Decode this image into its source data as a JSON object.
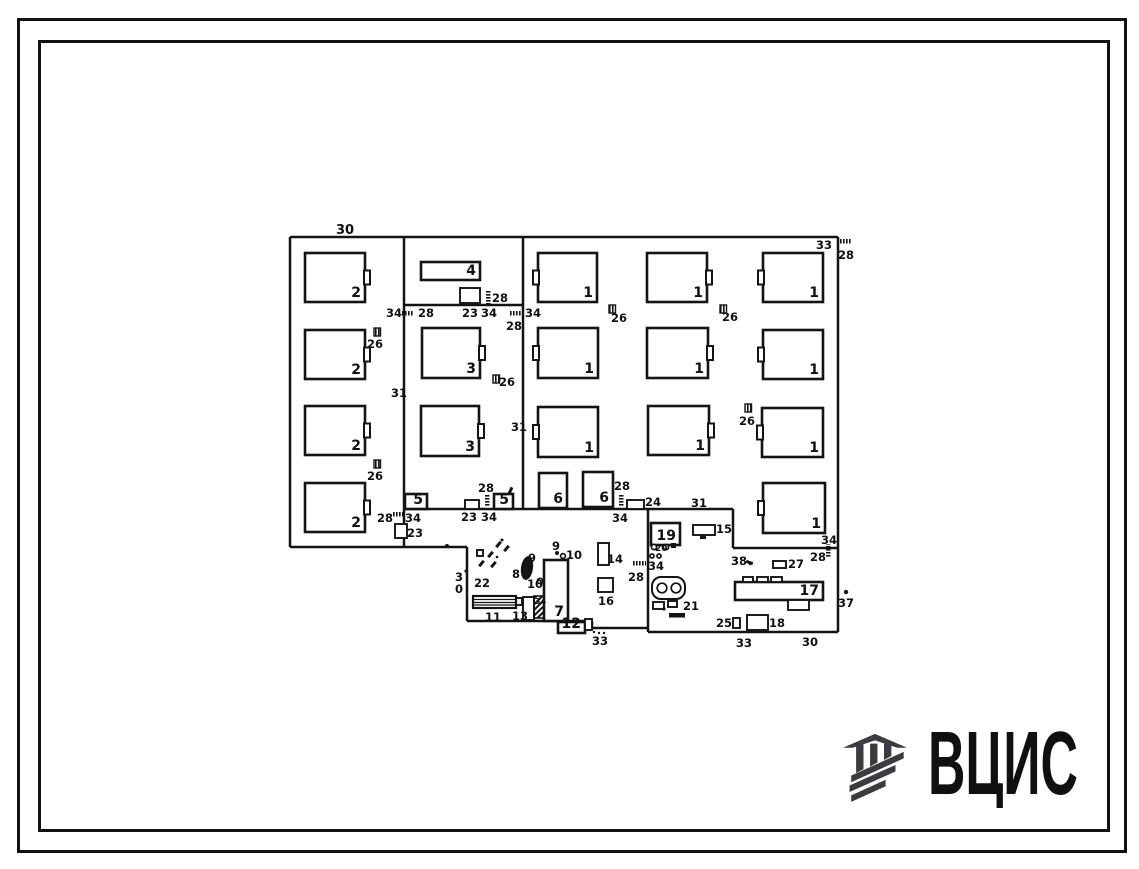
{
  "logo": {
    "text": "ВЦИС",
    "color": "#3b3b40"
  },
  "plan": {
    "stroke_color": "#141414",
    "walls": [
      [
        290,
        237,
        838,
        237
      ],
      [
        290,
        237,
        290,
        547
      ],
      [
        290,
        547,
        467,
        547
      ],
      [
        467,
        547,
        467,
        621
      ],
      [
        467,
        621,
        592,
        621
      ],
      [
        592,
        621,
        592,
        628
      ],
      [
        592,
        628,
        648,
        628
      ],
      [
        648,
        509,
        648,
        632
      ],
      [
        648,
        632,
        838,
        632
      ],
      [
        838,
        237,
        838,
        632
      ],
      [
        404,
        237,
        404,
        547
      ],
      [
        523,
        237,
        523,
        509
      ],
      [
        404,
        305,
        523,
        305
      ],
      [
        404,
        509,
        733,
        509
      ],
      [
        733,
        509,
        733,
        548
      ],
      [
        733,
        548,
        838,
        548
      ]
    ],
    "machines": [
      {
        "x": 305,
        "y": 253,
        "w": 60,
        "h": 49,
        "l": "2",
        "n": "r"
      },
      {
        "x": 305,
        "y": 330,
        "w": 60,
        "h": 49,
        "l": "2",
        "n": "r"
      },
      {
        "x": 305,
        "y": 406,
        "w": 60,
        "h": 49,
        "l": "2",
        "n": "r"
      },
      {
        "x": 305,
        "y": 483,
        "w": 60,
        "h": 49,
        "l": "2",
        "n": "r"
      },
      {
        "x": 421,
        "y": 262,
        "w": 59,
        "h": 18,
        "l": "4"
      },
      {
        "x": 422,
        "y": 328,
        "w": 58,
        "h": 50,
        "l": "3",
        "n": "r"
      },
      {
        "x": 421,
        "y": 406,
        "w": 58,
        "h": 50,
        "l": "3",
        "n": "r"
      },
      {
        "x": 538,
        "y": 253,
        "w": 59,
        "h": 49,
        "l": "1",
        "n": "l"
      },
      {
        "x": 647,
        "y": 253,
        "w": 60,
        "h": 49,
        "l": "1",
        "n": "r"
      },
      {
        "x": 763,
        "y": 253,
        "w": 60,
        "h": 49,
        "l": "1",
        "n": "l"
      },
      {
        "x": 538,
        "y": 328,
        "w": 60,
        "h": 50,
        "l": "1",
        "n": "l"
      },
      {
        "x": 647,
        "y": 328,
        "w": 61,
        "h": 50,
        "l": "1",
        "n": "r"
      },
      {
        "x": 763,
        "y": 330,
        "w": 60,
        "h": 49,
        "l": "1",
        "n": "l"
      },
      {
        "x": 538,
        "y": 407,
        "w": 60,
        "h": 50,
        "l": "1",
        "n": "l"
      },
      {
        "x": 648,
        "y": 406,
        "w": 61,
        "h": 49,
        "l": "1",
        "n": "r"
      },
      {
        "x": 762,
        "y": 408,
        "w": 61,
        "h": 49,
        "l": "1",
        "n": "l"
      },
      {
        "x": 763,
        "y": 483,
        "w": 62,
        "h": 50,
        "l": "1",
        "n": "l"
      },
      {
        "x": 405,
        "y": 494,
        "w": 22,
        "h": 15,
        "l": "5"
      },
      {
        "x": 494,
        "y": 494,
        "w": 19,
        "h": 15,
        "l": "5"
      },
      {
        "x": 539,
        "y": 473,
        "w": 28,
        "h": 35,
        "l": "6"
      },
      {
        "x": 583,
        "y": 472,
        "w": 30,
        "h": 35,
        "l": "6"
      },
      {
        "x": 651,
        "y": 523,
        "w": 29,
        "h": 22,
        "l": "19"
      },
      {
        "x": 544,
        "y": 560,
        "w": 24,
        "h": 61,
        "l": "7"
      },
      {
        "x": 558,
        "y": 622,
        "w": 27,
        "h": 11,
        "l": "12"
      },
      {
        "x": 735,
        "y": 582,
        "w": 88,
        "h": 18,
        "l": "17"
      }
    ],
    "smallrects": [
      [
        465,
        500,
        14,
        9
      ],
      [
        395,
        524,
        12,
        14
      ],
      [
        460,
        288,
        20,
        15
      ],
      [
        627,
        500,
        17,
        9
      ],
      [
        773,
        561,
        13,
        7
      ],
      [
        693,
        525,
        22,
        10
      ],
      [
        598,
        543,
        11,
        22
      ],
      [
        598,
        578,
        15,
        14
      ],
      [
        523,
        597,
        11,
        23
      ],
      [
        747,
        615,
        21,
        15
      ],
      [
        733,
        618,
        7,
        10
      ],
      [
        585,
        619,
        7,
        11
      ],
      [
        516,
        598,
        6,
        7
      ],
      [
        743,
        577,
        10,
        5
      ],
      [
        757,
        577,
        11,
        5
      ],
      [
        771,
        577,
        11,
        5
      ],
      [
        788,
        600,
        21,
        10
      ],
      [
        653,
        602,
        11,
        7
      ],
      [
        668,
        601,
        9,
        6
      ],
      [
        477,
        550,
        6,
        6
      ]
    ],
    "ticks": [
      [
        401,
        311,
        "h"
      ],
      [
        486,
        291,
        "v"
      ],
      [
        510,
        311,
        "h"
      ],
      [
        485,
        494,
        "v"
      ],
      [
        392,
        512,
        "h"
      ],
      [
        619,
        494,
        "v"
      ],
      [
        633,
        561,
        "h"
      ],
      [
        826,
        544,
        "v"
      ],
      [
        838,
        239,
        "h"
      ]
    ],
    "hatch_squares": [
      [
        374,
        328
      ],
      [
        374,
        460
      ],
      [
        493,
        375
      ],
      [
        609,
        305
      ],
      [
        720,
        305
      ],
      [
        745,
        404
      ]
    ],
    "hatch_rects": [
      [
        534,
        596,
        10,
        22
      ]
    ],
    "lathe": {
      "x": 473,
      "y": 596,
      "w": 43,
      "h": 12
    },
    "rrect": {
      "x": 652,
      "y": 577,
      "w": 33,
      "h": 22
    },
    "ellipse": {
      "cx": 527,
      "cy": 568,
      "rx": 6,
      "ry": 12,
      "rot": 8
    },
    "dashes": [
      [
        487,
        553,
        -50
      ],
      [
        478,
        562,
        -50
      ],
      [
        490,
        563,
        -50
      ],
      [
        495,
        543,
        -50
      ],
      [
        503,
        547,
        -50
      ],
      [
        507,
        489,
        -65
      ],
      [
        746,
        561,
        20
      ]
    ],
    "circles": [
      [
        662,
        588,
        4.8
      ],
      [
        676,
        588,
        4.8
      ],
      [
        654,
        547,
        2.6
      ],
      [
        666,
        547,
        2.6
      ],
      [
        652,
        556,
        2
      ],
      [
        659,
        556,
        2
      ],
      [
        540,
        581,
        2.6
      ],
      [
        563,
        556,
        2.4
      ]
    ],
    "dots": [
      [
        664,
        609,
        1.6
      ],
      [
        557,
        553,
        2
      ],
      [
        846,
        592,
        2.2
      ],
      [
        447,
        546,
        2
      ],
      [
        466,
        571,
        1.6
      ],
      [
        594,
        632,
        1.2
      ],
      [
        599,
        633,
        1.2
      ],
      [
        604,
        633,
        1.2
      ],
      [
        502,
        540,
        1.5
      ],
      [
        497,
        557,
        1.3
      ],
      [
        750,
        564,
        1.2
      ]
    ],
    "filled_squares": [
      [
        671,
        543,
        5,
        5
      ]
    ],
    "strips": [
      [
        669,
        613,
        16,
        4.5
      ],
      [
        700,
        535,
        6,
        4
      ]
    ],
    "labels": [
      {
        "x": 336,
        "y": 234,
        "t": "30",
        "s": 13
      },
      {
        "x": 386,
        "y": 317,
        "t": "34"
      },
      {
        "x": 418,
        "y": 317,
        "t": "28"
      },
      {
        "x": 462,
        "y": 317,
        "t": "23"
      },
      {
        "x": 481,
        "y": 317,
        "t": "34"
      },
      {
        "x": 492,
        "y": 302,
        "t": "28"
      },
      {
        "x": 506,
        "y": 330,
        "t": "28"
      },
      {
        "x": 525,
        "y": 317,
        "t": "34"
      },
      {
        "x": 391,
        "y": 397,
        "t": "31"
      },
      {
        "x": 511,
        "y": 431,
        "t": "31"
      },
      {
        "x": 691,
        "y": 507,
        "t": "31"
      },
      {
        "x": 367,
        "y": 348,
        "t": "26"
      },
      {
        "x": 367,
        "y": 480,
        "t": "26"
      },
      {
        "x": 499,
        "y": 386,
        "t": "26"
      },
      {
        "x": 611,
        "y": 322,
        "t": "26"
      },
      {
        "x": 722,
        "y": 321,
        "t": "26"
      },
      {
        "x": 739,
        "y": 425,
        "t": "26"
      },
      {
        "x": 816,
        "y": 249,
        "t": "33"
      },
      {
        "x": 838,
        "y": 259,
        "t": "28"
      },
      {
        "x": 478,
        "y": 492,
        "t": "28"
      },
      {
        "x": 481,
        "y": 521,
        "t": "34"
      },
      {
        "x": 461,
        "y": 521,
        "t": "23"
      },
      {
        "x": 377,
        "y": 522,
        "t": "28"
      },
      {
        "x": 405,
        "y": 522,
        "t": "34"
      },
      {
        "x": 407,
        "y": 537,
        "t": "23"
      },
      {
        "x": 614,
        "y": 490,
        "t": "28"
      },
      {
        "x": 612,
        "y": 522,
        "t": "34"
      },
      {
        "x": 645,
        "y": 506,
        "t": "24"
      },
      {
        "x": 628,
        "y": 581,
        "t": "28"
      },
      {
        "x": 731,
        "y": 565,
        "t": "38"
      },
      {
        "x": 788,
        "y": 568,
        "t": "27"
      },
      {
        "x": 716,
        "y": 533,
        "t": "15"
      },
      {
        "x": 821,
        "y": 544,
        "t": "34"
      },
      {
        "x": 810,
        "y": 561,
        "t": "28"
      },
      {
        "x": 838,
        "y": 607,
        "t": "37"
      },
      {
        "x": 474,
        "y": 587,
        "t": "22"
      },
      {
        "x": 512,
        "y": 578,
        "t": "8"
      },
      {
        "x": 528,
        "y": 562,
        "t": "9"
      },
      {
        "x": 527,
        "y": 588,
        "t": "10"
      },
      {
        "x": 552,
        "y": 550,
        "t": "9"
      },
      {
        "x": 566,
        "y": 559,
        "t": "10"
      },
      {
        "x": 607,
        "y": 563,
        "t": "14"
      },
      {
        "x": 598,
        "y": 605,
        "t": "16"
      },
      {
        "x": 512,
        "y": 620,
        "t": "13"
      },
      {
        "x": 485,
        "y": 621,
        "t": "11"
      },
      {
        "x": 535,
        "y": 604,
        "t": "34",
        "s": 8
      },
      {
        "x": 592,
        "y": 645,
        "t": "33"
      },
      {
        "x": 655,
        "y": 551,
        "t": "20",
        "s": 9
      },
      {
        "x": 648,
        "y": 570,
        "t": "34"
      },
      {
        "x": 683,
        "y": 610,
        "t": "21"
      },
      {
        "x": 716,
        "y": 627,
        "t": "25"
      },
      {
        "x": 769,
        "y": 627,
        "t": "18"
      },
      {
        "x": 736,
        "y": 647,
        "t": "33"
      },
      {
        "x": 802,
        "y": 646,
        "t": "30"
      },
      {
        "x": 455,
        "y": 581,
        "t": "3"
      },
      {
        "x": 455,
        "y": 593,
        "t": "0"
      }
    ]
  }
}
